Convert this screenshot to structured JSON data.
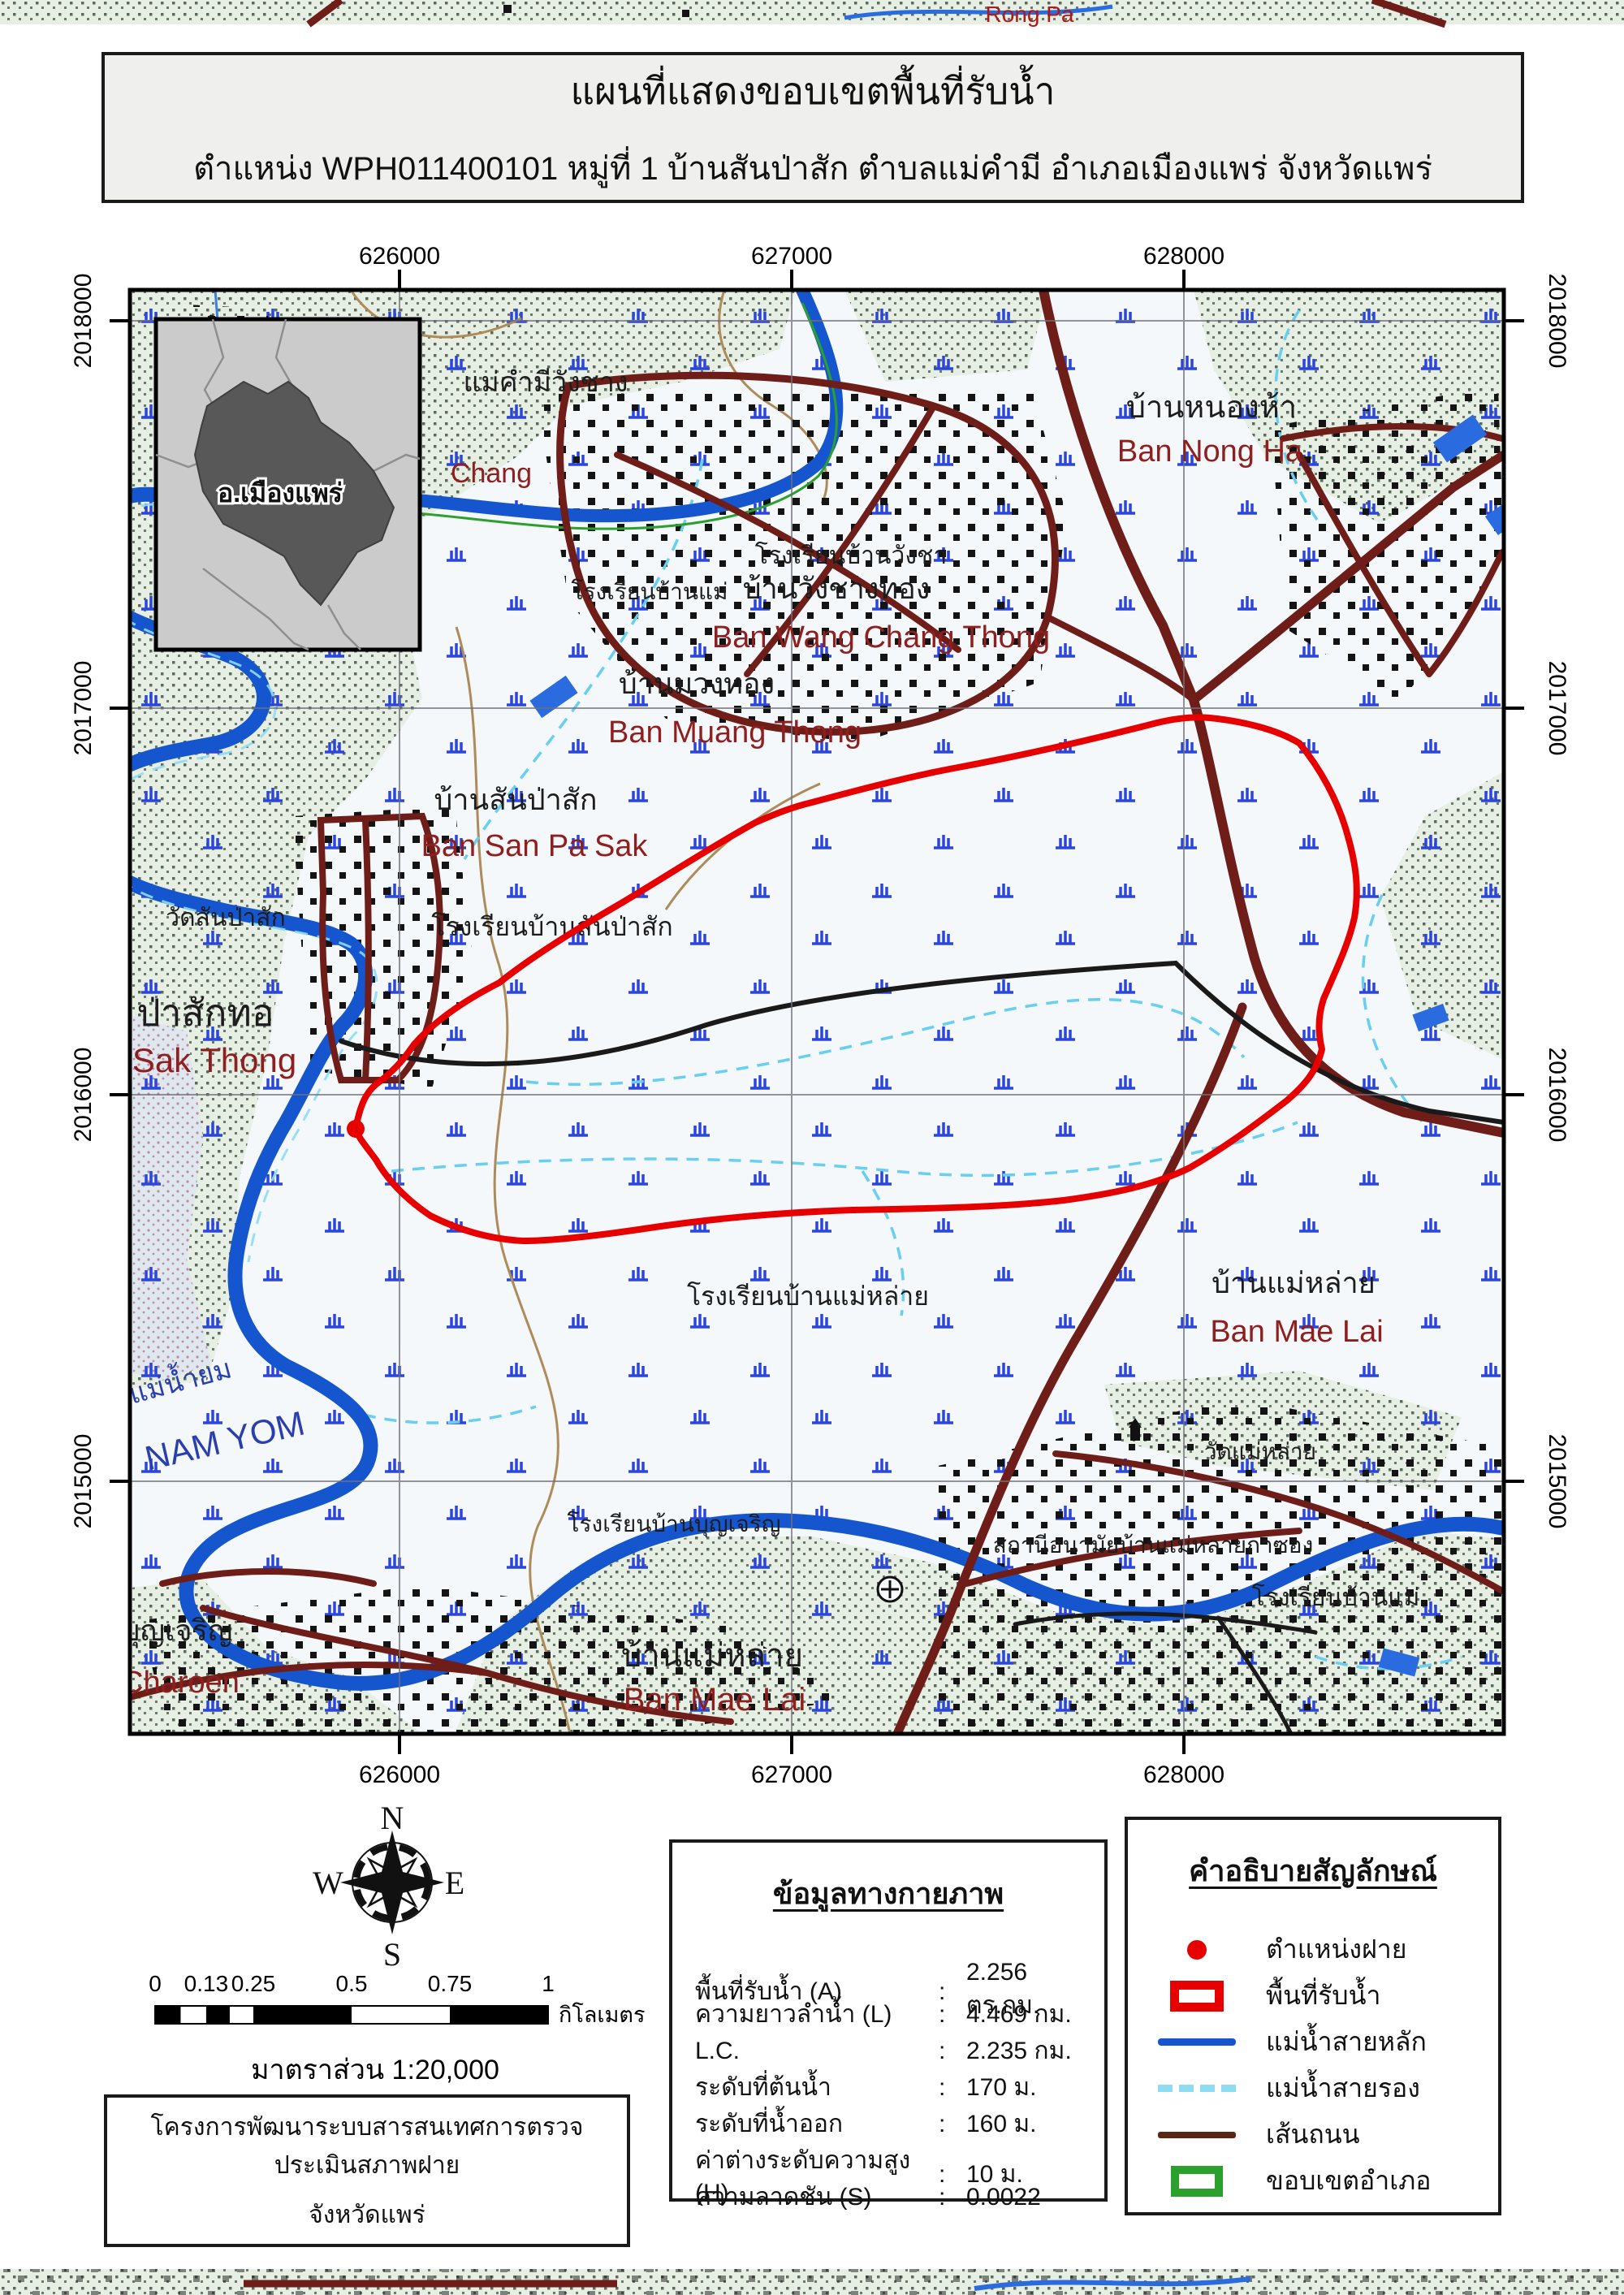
{
  "title": {
    "line1": "แผนที่แสดงขอบเขตพื้นที่รับน้ำ",
    "line2": "ตำแหน่ง WPH011400101 หมู่ที่ 1 บ้านสันป่าสัก ตำบลแม่คำมี อำเภอเมืองแพร่ จังหวัดแพร่"
  },
  "map": {
    "x_ticks": [
      "626000",
      "627000",
      "628000"
    ],
    "y_ticks": [
      "2018000",
      "2017000",
      "2016000",
      "2015000"
    ],
    "inset_label": "อ.เมืองแพร่",
    "strip_label": "Rong Pa",
    "places": [
      {
        "t": "แม่คำมีวังชาง",
        "c": "blk",
        "x": 672,
        "y": 482,
        "s": 34
      },
      {
        "t": "Chang",
        "c": "red",
        "x": 605,
        "y": 594,
        "s": 34
      },
      {
        "t": "บ้านหนองห้า",
        "c": "blk",
        "x": 1492,
        "y": 514,
        "s": 38
      },
      {
        "t": "Ban Nong Ha",
        "c": "red",
        "x": 1490,
        "y": 568,
        "s": 38
      },
      {
        "t": "โรงเรียนบ้านวังชา",
        "c": "blk",
        "x": 1048,
        "y": 694,
        "s": 30
      },
      {
        "t": "โรงเรียนบ้านแม่",
        "c": "blk",
        "x": 800,
        "y": 738,
        "s": 28
      },
      {
        "t": "บ้านวังชางทอง",
        "c": "blk",
        "x": 1030,
        "y": 737,
        "s": 36
      },
      {
        "t": "Ban Wang Chang Thong",
        "c": "red",
        "x": 1085,
        "y": 797,
        "s": 38
      },
      {
        "t": "บ้านมวงทอง",
        "c": "blk",
        "x": 858,
        "y": 854,
        "s": 36
      },
      {
        "t": "Ban Muang Thong",
        "c": "red",
        "x": 905,
        "y": 914,
        "s": 38
      },
      {
        "t": "บ้านสันป่าสัก",
        "c": "blk",
        "x": 635,
        "y": 997,
        "s": 36
      },
      {
        "t": "Ban San Pa Sak",
        "c": "red",
        "x": 658,
        "y": 1054,
        "s": 38
      },
      {
        "t": "โรงเรียนบ้านสันป่าสัก",
        "c": "blk",
        "x": 680,
        "y": 1152,
        "s": 32
      },
      {
        "t": "วัดสันป่าสัก",
        "c": "blk",
        "x": 278,
        "y": 1140,
        "s": 30
      },
      {
        "t": "ป่าสักทอ",
        "c": "blk",
        "x": 253,
        "y": 1263,
        "s": 46
      },
      {
        "t": "Sak Thong",
        "c": "red",
        "x": 264,
        "y": 1320,
        "s": 42
      },
      {
        "t": "แม่น้ำยม",
        "c": "blue",
        "x": 225,
        "y": 1712,
        "s": 34,
        "r": -15
      },
      {
        "t": "NAM YOM",
        "c": "blue",
        "x": 280,
        "y": 1788,
        "s": 42,
        "r": -13
      },
      {
        "t": "โรงเรียนบ้านแม่หล่าย",
        "c": "blk",
        "x": 995,
        "y": 1607,
        "s": 32
      },
      {
        "t": "บ้านแม่หล่าย",
        "c": "blk",
        "x": 1593,
        "y": 1592,
        "s": 36
      },
      {
        "t": "Ban Mae Lai",
        "c": "red",
        "x": 1597,
        "y": 1652,
        "s": 38
      },
      {
        "t": "วัดแม่หล่าย",
        "c": "blk",
        "x": 1552,
        "y": 1797,
        "s": 28
      },
      {
        "t": "สถานีอนามัยบ้านแม่หลายกาซอง",
        "c": "blk",
        "x": 1420,
        "y": 1912,
        "s": 28
      },
      {
        "t": "โรงเรียนบ้านแม่",
        "c": "blk",
        "x": 1645,
        "y": 1977,
        "s": 30
      },
      {
        "t": "โรงเรียนบ้านบุญเจริญ",
        "c": "blk",
        "x": 830,
        "y": 1886,
        "s": 28
      },
      {
        "t": "บุญเจริญ",
        "c": "blk",
        "x": 218,
        "y": 2020,
        "s": 36
      },
      {
        "t": "Charoen",
        "c": "red",
        "x": 222,
        "y": 2084,
        "s": 38
      },
      {
        "t": "บ้านแม่หล่าย",
        "c": "blk",
        "x": 877,
        "y": 2052,
        "s": 40
      },
      {
        "t": "Ban Mae Lai",
        "c": "red",
        "x": 880,
        "y": 2106,
        "s": 40
      }
    ]
  },
  "compass": {
    "n": "N",
    "s": "S",
    "e": "E",
    "w": "W"
  },
  "scalebar": {
    "ticks": [
      {
        "v": 0,
        "label": "0"
      },
      {
        "v": 0.13,
        "label": "0.13"
      },
      {
        "v": 0.25,
        "label": "0.25"
      },
      {
        "v": 0.5,
        "label": "0.5"
      },
      {
        "v": 0.75,
        "label": "0.75"
      },
      {
        "v": 1,
        "label": "1"
      }
    ],
    "segments": [
      {
        "a": 0,
        "b": 0.065,
        "fill": "black"
      },
      {
        "a": 0.065,
        "b": 0.13,
        "fill": "white"
      },
      {
        "a": 0.13,
        "b": 0.19,
        "fill": "black"
      },
      {
        "a": 0.19,
        "b": 0.25,
        "fill": "white"
      },
      {
        "a": 0.25,
        "b": 0.5,
        "fill": "black"
      },
      {
        "a": 0.5,
        "b": 0.75,
        "fill": "white"
      },
      {
        "a": 0.75,
        "b": 1,
        "fill": "black"
      }
    ],
    "unit": "กิโลเมตร",
    "scale_text": "มาตราส่วน  1:20,000"
  },
  "info": {
    "title": "ข้อมูลทางกายภาพ",
    "colon": ":",
    "rows": [
      {
        "label": "พื้นที่รับน้ำ (A)",
        "value": "2.256 ตร.กม."
      },
      {
        "label": "ความยาวลำน้ำ (L)",
        "value": "4.469 กม."
      },
      {
        "label": "L.C.",
        "value": "2.235 กม."
      },
      {
        "label": "ระดับที่ต้นน้ำ",
        "value": "170 ม."
      },
      {
        "label": "ระดับที่น้ำออก",
        "value": "160 ม."
      },
      {
        "label": "ค่าต่างระดับความสูง (H)",
        "value": "10 ม."
      },
      {
        "label": "ความลาดชัน (S)",
        "value": "0.0022"
      }
    ]
  },
  "legend": {
    "title": "คำอธิบายสัญลักษณ์",
    "items": [
      {
        "type": "dot",
        "label": "ตำแหน่งฝาย"
      },
      {
        "type": "rect",
        "label": "พื้นที่รับน้ำ"
      },
      {
        "type": "line",
        "label": "แม่น้ำสายหลัก"
      },
      {
        "type": "dash",
        "label": "แม่น้ำสายรอง"
      },
      {
        "type": "road",
        "label": "เส้นถนน"
      },
      {
        "type": "grect",
        "label": "ขอบเขตอำเภอ"
      }
    ]
  },
  "project": {
    "line1": "โครงการพัฒนาระบบสารสนเทศการตรวจประเมินสภาพฝาย",
    "line2": "จังหวัดแพร่"
  },
  "colors": {
    "weir": "#e60000",
    "watershed_boundary": "#e60000",
    "river_main": "#1556cf",
    "river_secondary": "#8edcf2",
    "road_map": "#6f1d18",
    "road_legend": "#5a2613",
    "district_boundary": "#2ca02c"
  }
}
